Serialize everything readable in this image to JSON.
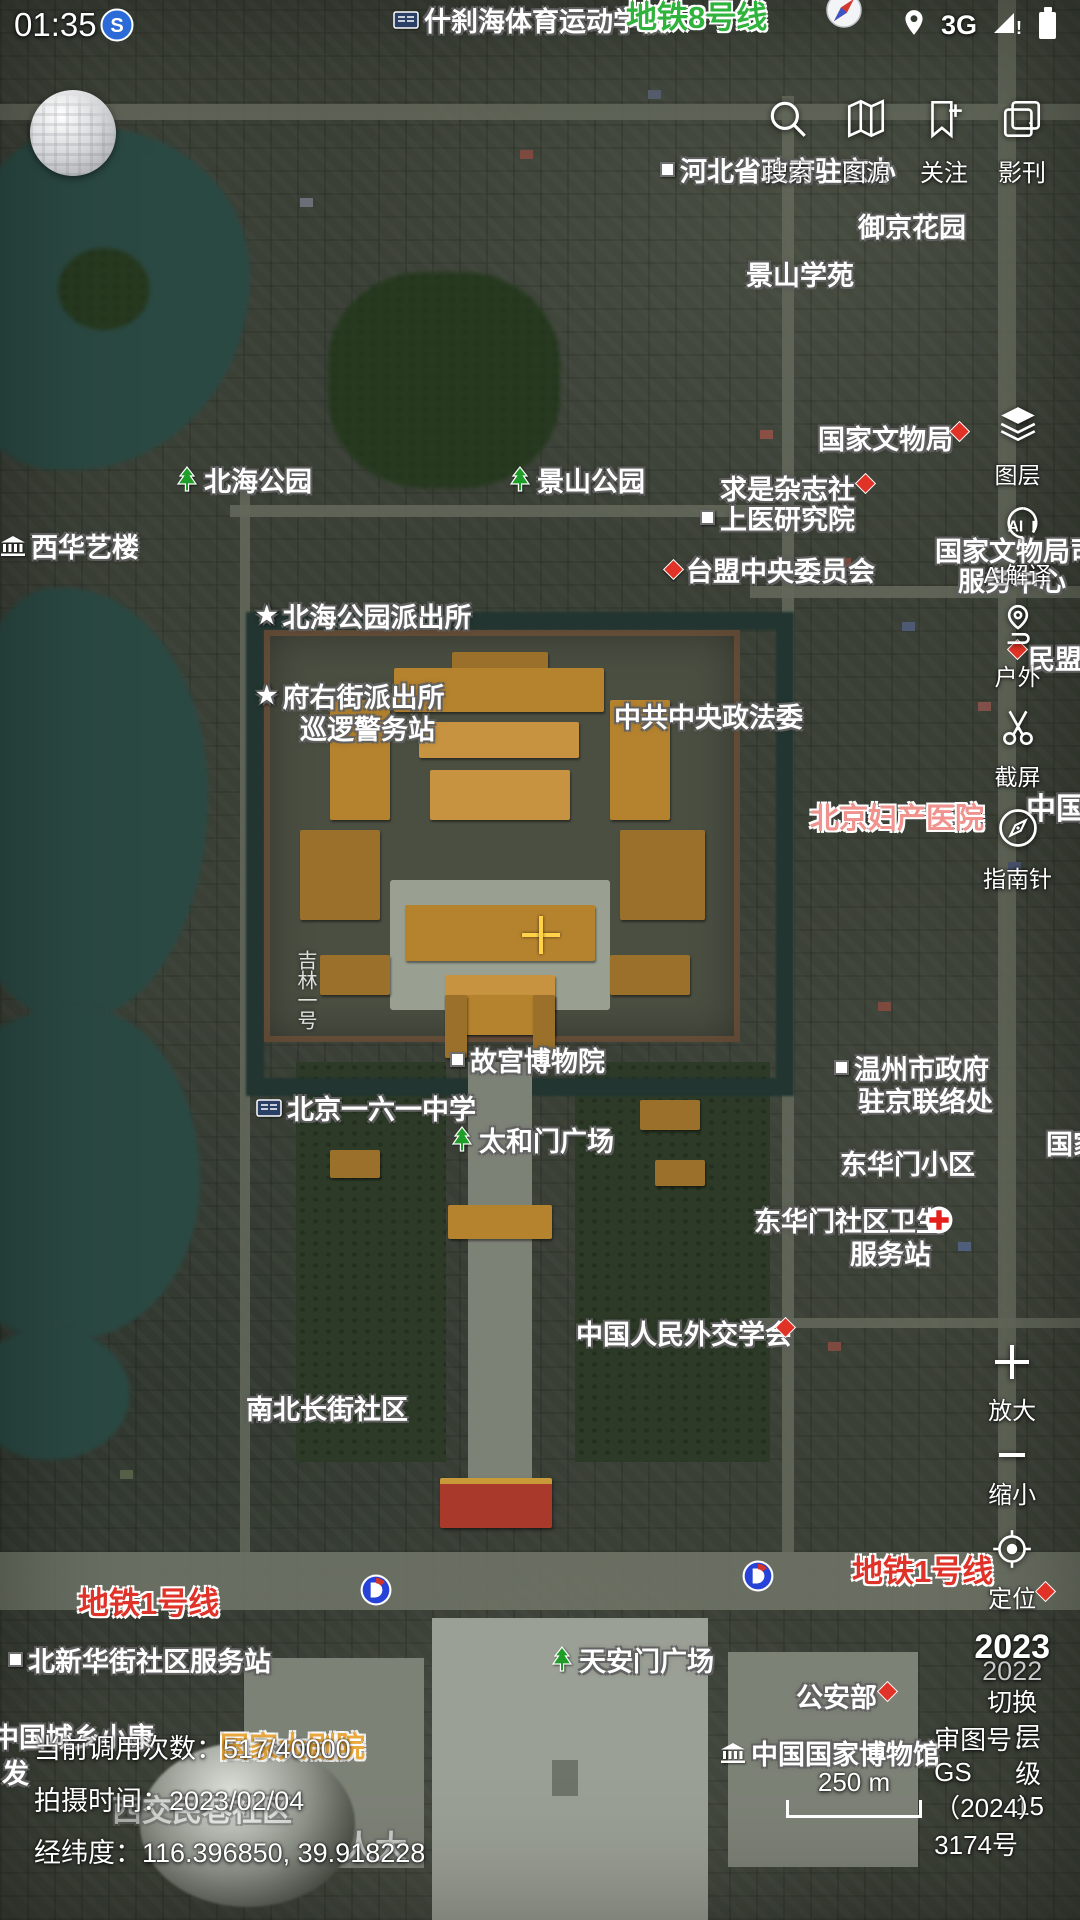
{
  "status_bar": {
    "time": "01:35",
    "network": "3G"
  },
  "top_toolbar": {
    "items": [
      {
        "id": "search",
        "label": "搜索"
      },
      {
        "id": "map-source",
        "label": "图源"
      },
      {
        "id": "follow",
        "label": "关注"
      },
      {
        "id": "imagery",
        "label": "影刊"
      }
    ]
  },
  "right_toolbar": {
    "items": [
      {
        "id": "layers",
        "label": "图层"
      },
      {
        "id": "ai-interpret",
        "label": "AI解译"
      },
      {
        "id": "outdoor",
        "label": "户外"
      },
      {
        "id": "screenshot",
        "label": "截屏"
      },
      {
        "id": "compass",
        "label": "指南针"
      }
    ]
  },
  "map_controls": {
    "zoom_in": "放大",
    "zoom_out": "缩小",
    "locate": "定位",
    "year_current": "2023",
    "year_previous": "2022",
    "year_switch": "切换"
  },
  "bottom_info": {
    "api_calls": "当前调用次数：517/40000",
    "capture_time": "拍摄时间：2023/02/04",
    "coordinates": "经纬度：116.396850, 39.918228"
  },
  "map_footer": {
    "scale_text": "250 m",
    "zoom_level": "层级15",
    "license": "审图号：GS（2024）3174号"
  },
  "map_labels": [
    {
      "text": "什刹海体育运动学校",
      "x": 393,
      "y": 0,
      "icon": "school"
    },
    {
      "text": "地铁8号线",
      "x": 626,
      "y": -8,
      "style": "green",
      "size": 31
    },
    {
      "text": "河北省政府驻京办",
      "x": 660,
      "y": 150,
      "icon": "dot"
    },
    {
      "text": "御京花园",
      "x": 858,
      "y": 206
    },
    {
      "text": "景山学苑",
      "x": 746,
      "y": 254
    },
    {
      "text": "国家文物局",
      "x": 818,
      "y": 418
    },
    {
      "text": "北海公园",
      "x": 175,
      "y": 460,
      "icon": "tree"
    },
    {
      "text": "景山公园",
      "x": 508,
      "y": 460,
      "icon": "tree"
    },
    {
      "text": "求是杂志社",
      "x": 720,
      "y": 468
    },
    {
      "text": "上医研究院",
      "x": 700,
      "y": 498,
      "icon": "dot"
    },
    {
      "text": "西华艺楼",
      "x": 0,
      "y": 526,
      "icon": "museum"
    },
    {
      "text": "台盟中央委员会",
      "x": 666,
      "y": 550,
      "icon": "diamond"
    },
    {
      "text": "国家文物局司机",
      "x": 935,
      "y": 530
    },
    {
      "text": "服务中心",
      "x": 958,
      "y": 560
    },
    {
      "text": "北海公园派出所",
      "x": 256,
      "y": 596,
      "icon": "star"
    },
    {
      "text": "民盟中央",
      "x": 1028,
      "y": 638
    },
    {
      "text": "府右街派出所",
      "x": 256,
      "y": 676,
      "icon": "star"
    },
    {
      "text": "巡逻警务站",
      "x": 300,
      "y": 708
    },
    {
      "text": "中共中央政法委",
      "x": 614,
      "y": 696
    },
    {
      "text": "北京妇产医院",
      "x": 810,
      "y": 795,
      "style": "pink",
      "size": 29
    },
    {
      "text": "中国",
      "x": 1026,
      "y": 784,
      "size": 30
    },
    {
      "text": "吉林一号",
      "x": 291,
      "y": 950,
      "style": "watermark",
      "vertical": true
    },
    {
      "text": "故宫博物院",
      "x": 450,
      "y": 1040,
      "icon": "dot"
    },
    {
      "text": "温州市政府",
      "x": 834,
      "y": 1048,
      "icon": "dot"
    },
    {
      "text": "驻京联络处",
      "x": 858,
      "y": 1080
    },
    {
      "text": "北京一六一中学",
      "x": 256,
      "y": 1088,
      "icon": "school"
    },
    {
      "text": "太和门广场",
      "x": 450,
      "y": 1120,
      "icon": "tree"
    },
    {
      "text": "东华门小区",
      "x": 840,
      "y": 1143
    },
    {
      "text": "国家",
      "x": 1046,
      "y": 1123
    },
    {
      "text": "东华门社区卫生",
      "x": 754,
      "y": 1200
    },
    {
      "text": "服务站",
      "x": 850,
      "y": 1233
    },
    {
      "text": "中国人民外交学会",
      "x": 576,
      "y": 1313
    },
    {
      "text": "南北长街社区",
      "x": 246,
      "y": 1388
    },
    {
      "text": "地铁1号线",
      "x": 78,
      "y": 1578,
      "style": "red",
      "size": 31
    },
    {
      "text": "地铁1号线",
      "x": 852,
      "y": 1546,
      "style": "red",
      "size": 31
    },
    {
      "text": "北新华街社区服务站",
      "x": 8,
      "y": 1640,
      "icon": "dot"
    },
    {
      "text": "天安门广场",
      "x": 550,
      "y": 1640,
      "icon": "tree"
    },
    {
      "text": "公安部",
      "x": 796,
      "y": 1676
    },
    {
      "text": "中国城乡小康",
      "x": -8,
      "y": 1716
    },
    {
      "text": "发",
      "x": 2,
      "y": 1752
    },
    {
      "text": "国家大剧院",
      "x": 220,
      "y": 1724,
      "style": "orange",
      "size": 29
    },
    {
      "text": "中国国家博物馆",
      "x": 720,
      "y": 1733,
      "icon": "museum"
    },
    {
      "text": "西交民巷社区",
      "x": 112,
      "y": 1786,
      "style": "faint",
      "size": 30
    },
    {
      "text": "人大",
      "x": 343,
      "y": 1822,
      "style": "faint",
      "size": 32
    }
  ],
  "map_markers": [
    {
      "type": "diamond",
      "x": 952,
      "y": 424
    },
    {
      "type": "diamond",
      "x": 858,
      "y": 476
    },
    {
      "type": "diamond",
      "x": 1010,
      "y": 642
    },
    {
      "type": "diamond",
      "x": 778,
      "y": 1320
    },
    {
      "type": "diamond",
      "x": 880,
      "y": 1684
    },
    {
      "type": "diamond",
      "x": 1038,
      "y": 1584
    },
    {
      "type": "cross",
      "x": 925,
      "y": 1206
    },
    {
      "type": "metro",
      "x": 360,
      "y": 1574
    },
    {
      "type": "metro",
      "x": 742,
      "y": 1560
    },
    {
      "type": "station",
      "x": 100,
      "y": 8
    },
    {
      "type": "compass-rose",
      "x": 826,
      "y": -8
    }
  ],
  "colors": {
    "label_green": "#2fb33c",
    "label_red": "#df332a",
    "label_pink": "#f0928d",
    "label_orange": "#e9a93f",
    "water": "#2b4943",
    "palace_roof": "#b5832e",
    "crosshair": "#ffd24a"
  }
}
